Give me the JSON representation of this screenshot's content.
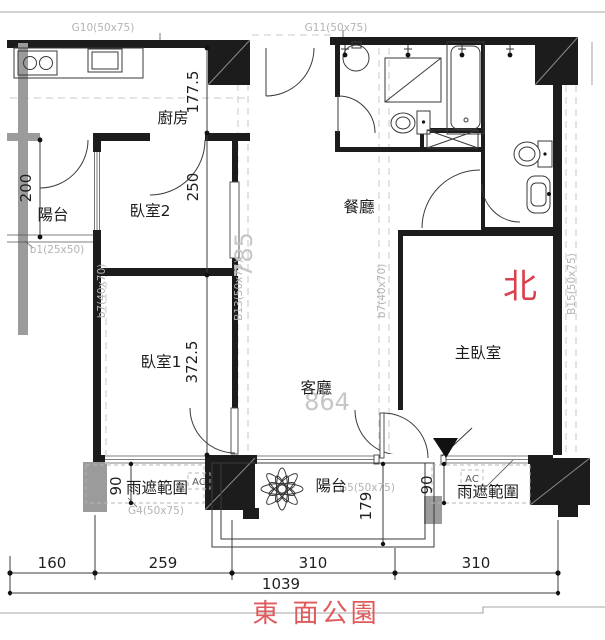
{
  "colors": {
    "wall": "#1c1c1c",
    "gray_wall": "#9b9b9b",
    "north_red": "#d8414e",
    "site_red": "#e05a5c",
    "beam_label_gray": "#b3b3b3",
    "big_dim_gray": "#c6c6c6"
  },
  "rooms": {
    "kitchen": "廚房",
    "balcony_left": "陽台",
    "bedroom2": "臥室2",
    "bedroom1": "臥室1",
    "dining": "餐廳",
    "living": "客廳",
    "master": "主臥室",
    "balcony_bottom": "陽台"
  },
  "labels": {
    "north": "北",
    "site": "東 面公園",
    "rain_left": "雨遮範圍",
    "rain_right": "雨遮範圍",
    "ac_left": "AC",
    "ac_right": "AC"
  },
  "beams": {
    "g10": "G10(50x75)",
    "g11": "G11(50x75)",
    "b1": "b1(25x50)",
    "b7_left": "b7(40x70)",
    "b13": "B13(50x75)",
    "b7_right": "b7(40x70)",
    "b15": "B15(50x75)",
    "g4": "G4(50x75)",
    "g5": "G5(50x75)"
  },
  "dims": {
    "kitchen_depth": "177.5",
    "balcony_left_h": "200",
    "bedroom2_h": "250",
    "bedroom1_h": "372.5",
    "hall_len": "785",
    "living_w": "864",
    "rain_left_w": "90",
    "rain_right_w": "90",
    "balcony_depth": "179",
    "seg1": "160",
    "seg2": "259",
    "seg3": "310",
    "seg4": "310",
    "total": "1039"
  }
}
